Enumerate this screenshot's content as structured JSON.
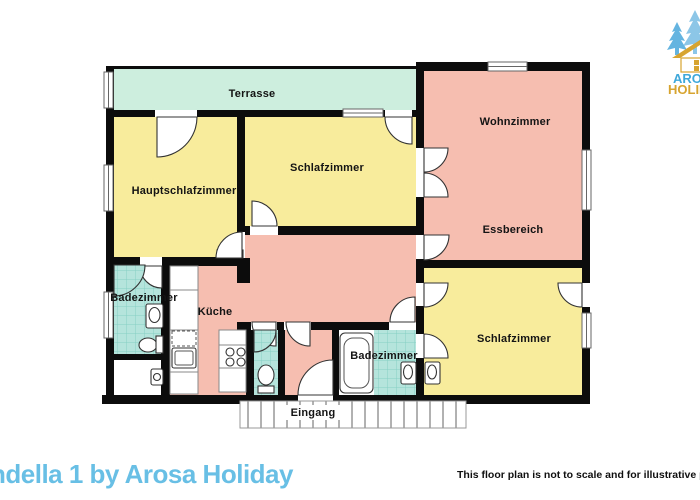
{
  "branding": {
    "logo_line1": "AROSA",
    "logo_line2": "HOLIDAY",
    "logo_blue": "#3fa8da",
    "logo_gold": "#d7a430",
    "tree_blue": "#8cc6e7",
    "tree_blue_dark": "#64b4e0"
  },
  "footer": {
    "title": "ndella 1 by Arosa Holiday",
    "title_color": "#68bfe5",
    "disclaimer": "This floor plan is not to scale and for illustrative purposes"
  },
  "floorplan": {
    "wall_color": "#0c0c0c",
    "room_colors": {
      "terrace": "#cdeede",
      "bedroom": "#f8ec9c",
      "living": "#f6beb0",
      "bath": "#b5e4dc",
      "bath_grid": "#86cfc4",
      "walkway_line": "#909090"
    },
    "labels": {
      "terrasse": "Terrasse",
      "hauptschlafzimmer": "Hauptschlafzimmer",
      "schlafzimmer_top": "Schlafzimmer",
      "wohnzimmer": "Wohnzimmer",
      "essbereich": "Essbereich",
      "badezimmer_left": "Badezimmer",
      "kueche": "Küche",
      "badezimmer_bottom": "Badezimmer",
      "schlafzimmer_bottom": "Schlafzimmer",
      "eingang": "Eingang"
    }
  }
}
